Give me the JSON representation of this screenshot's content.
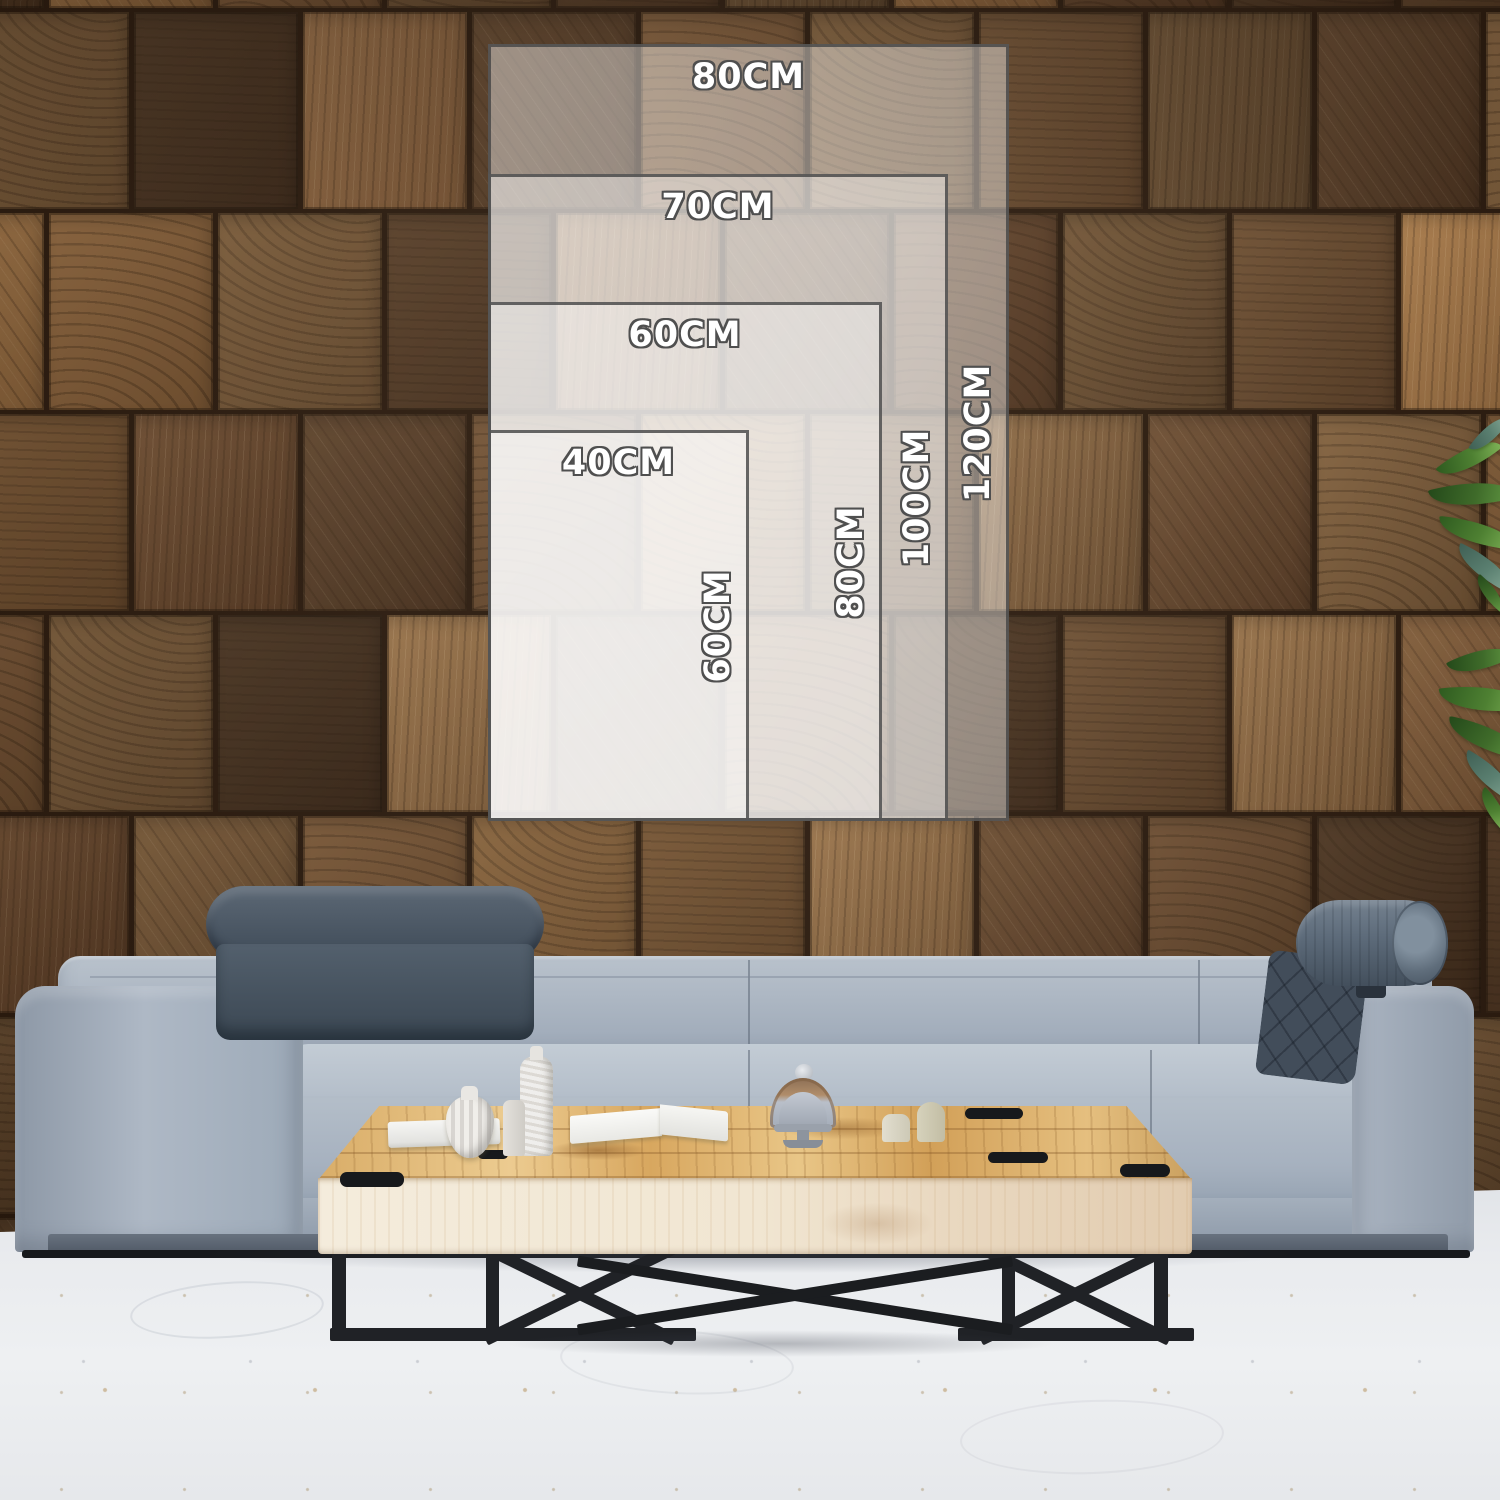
{
  "size_guide": {
    "sizes": [
      {
        "name": "80x120",
        "width_label": "80CM",
        "height_label": "120CM"
      },
      {
        "name": "70x100",
        "width_label": "70CM",
        "height_label": "100CM"
      },
      {
        "name": "60x80",
        "width_label": "60CM",
        "height_label": "80CM"
      },
      {
        "name": "40x60",
        "width_label": "40CM",
        "height_label": "60CM"
      }
    ]
  },
  "colors": {
    "wall_tones": [
      "#6b4a2e",
      "#7b5635",
      "#5d3f27",
      "#8a6038",
      "#4e3521",
      "#966b3f",
      "#715233",
      "#83603c",
      "#593b24"
    ],
    "overlay_fill": "rgba(255,255,255,0.42)",
    "overlay_border": "rgba(70,70,70,0.82)",
    "label_text": "#ffffff",
    "label_outline": "#4f4f4f",
    "floor": "#e9ebee",
    "sofa_gray": "#aeb8c4",
    "sofa_gray_dark": "#97a2b0",
    "headrest_dark": "#47525f",
    "bolster": "#5d6b7a",
    "plinth": "#59636f",
    "rail": "#17191c",
    "table_top": "#e2b977",
    "table_face": "#f1e7d4",
    "table_leg": "#202226",
    "leaf_green": "#4e8032"
  }
}
